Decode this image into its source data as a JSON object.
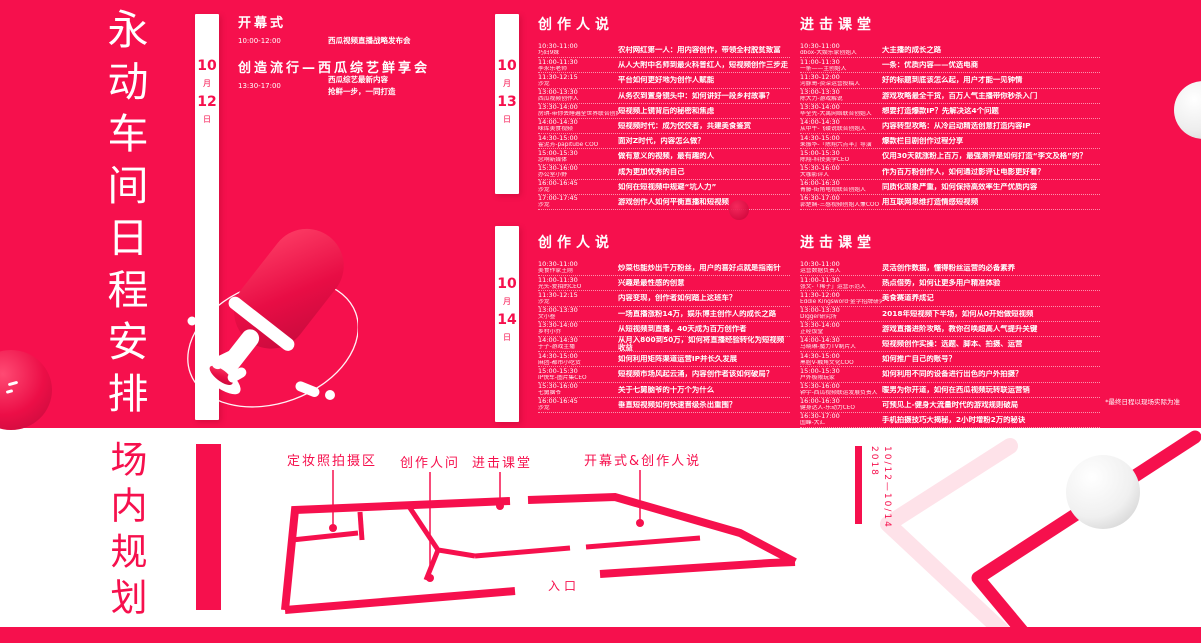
{
  "accent_color": "#F6104D",
  "poster_title": "永动车间日程安排",
  "venue_title": "场内规划",
  "footnote": "*最终日程以现场实际为准",
  "days": {
    "d12": {
      "month": "10",
      "month_label": "月",
      "day": "12",
      "day_label": "日"
    },
    "d13": {
      "month": "10",
      "month_label": "月",
      "day": "13",
      "day_label": "日"
    },
    "d14": {
      "month": "10",
      "month_label": "月",
      "day": "14",
      "day_label": "日"
    }
  },
  "opening": {
    "s1_title": "开幕式",
    "s1_time": "10:00-12:00",
    "s1_desc": "西瓜视频直播战略发布会",
    "s2_title": "创造流行—西瓜综艺鲜享会",
    "s2_time": "13:30-17:00",
    "s2_desc1": "西瓜综艺最新内容",
    "s2_desc2": "抢鲜一步，一同打造"
  },
  "day13": {
    "creators": {
      "header": "创作人说",
      "rows": [
        {
          "time": "10:30-11:00",
          "who": "巧妇9妹",
          "topic": "农村网红第一人：用内容创作，带领全村脱贫致富"
        },
        {
          "time": "11:00-11:30",
          "who": "李永乐老师",
          "topic": "从人大附中名师到最火科普红人，短视频创作三步走"
        },
        {
          "time": "11:30-12:15",
          "who": "沙龙",
          "topic": "平台如何更好地为创作人赋能"
        },
        {
          "time": "13:00-13:30",
          "who": "西瓜视频创作人",
          "topic": "从务农到置身镜头中：如何讲好一段乡村故事？"
        },
        {
          "time": "13:30-14:00",
          "who": "房琪-带你去睡遍全世界联合创始人",
          "topic": "短视频上镜背后的秘密和焦虑"
        },
        {
          "time": "14:00-14:30",
          "who": "味库美食视频",
          "topic": "短视频时代：成为佼佼者，共建美食鉴赏"
        },
        {
          "time": "14:30-15:00",
          "who": "霍泥芳-papitube COO",
          "topic": "面对Z时代，内容怎么做？"
        },
        {
          "time": "15:00-15:30",
          "who": "念响新媒体",
          "topic": "做有意义的视频，最有趣的人"
        },
        {
          "time": "15:30-16:00",
          "who": "办公室小野",
          "topic": "成为更加优秀的自己"
        },
        {
          "time": "16:00-16:45",
          "who": "沙龙",
          "topic": "如何在短视频中规避“坑人力”"
        },
        {
          "time": "17:00-17:45",
          "who": "沙龙",
          "topic": "游戏创作人如何平衡直播和短视频"
        }
      ]
    },
    "classroom": {
      "header": "进击课堂",
      "rows": [
        {
          "time": "10:30-11:00",
          "who": "dbox-大娱乐家创始人",
          "topic": "大主播的成长之路"
        },
        {
          "time": "11:00-11:30",
          "who": "一条——主创始人",
          "topic": "一条：优质内容——优选电商"
        },
        {
          "time": "11:30-12:00",
          "who": "河豚哥-资深运营投稿人",
          "topic": "好的标题到底该怎么起，用户才能一见钟情"
        },
        {
          "time": "13:00-13:30",
          "who": "陈大力-游戏解说",
          "topic": "游戏攻略最全干货，百万人气主播带你秒杀入门"
        },
        {
          "time": "13:30-14:00",
          "who": "毕全先-大禹网络联合创始人",
          "topic": "想要打造爆款IP？先解决这4个问题"
        },
        {
          "time": "14:00-14:30",
          "who": "从中午-飞碟说联合创始人",
          "topic": "内容转型攻略：从冷启动精选创意打造内容IP"
        },
        {
          "time": "14:30-15:00",
          "who": "朱振华-『陈翔六点半』导演",
          "topic": "爆款栏目剧创作过程分享"
        },
        {
          "time": "15:00-15:30",
          "who": "陈翔-科技美学CEO",
          "topic": "仅用30天就涨粉上百万，最强测评是如何打造“李文及格”的？"
        },
        {
          "time": "15:30-16:00",
          "who": "大咖影评人",
          "topic": "作为百万粉创作人，如何通过影评让电影更好看？"
        },
        {
          "time": "16:00-16:30",
          "who": "青藤-街角电视联合创始人",
          "topic": "同质化现象严重，如何保持高效率生产优质内容"
        },
        {
          "time": "16:30-17:00",
          "who": "郭楚娴-三感视频创始人兼COO",
          "topic": "用互联网思维打造情感短视频"
        }
      ]
    }
  },
  "day14": {
    "creators": {
      "header": "创作人说",
      "rows": [
        {
          "time": "10:30-11:00",
          "who": "美食作家王刚",
          "topic": "炒菜也能炒出千万粉丝，用户的喜好点就是指南针"
        },
        {
          "time": "11:00-11:30",
          "who": "光头-爱拍的CEO",
          "topic": "兴趣是最性感的创意"
        },
        {
          "time": "11:30-12:15",
          "who": "沙龙",
          "topic": "内容变现，创作者如何踏上这班车？"
        },
        {
          "time": "13:00-13:30",
          "who": "文小叁",
          "topic": "一场直播涨粉14万，娱乐博主创作人的成长之路"
        },
        {
          "time": "13:30-14:00",
          "who": "乡村小乔",
          "topic": "从短视频到直播，40天成为百万创作者"
        },
        {
          "time": "14:00-14:30",
          "who": "于子-游戏主播",
          "topic": "从月入800到50万，如何将直播经验转化为短视频收益"
        },
        {
          "time": "14:30-15:00",
          "who": "麻团-都市小吃货",
          "topic": "如何利用矩阵渠道运营IP并长久发展"
        },
        {
          "time": "15:00-15:30",
          "who": "IP快车-图片集CEO",
          "topic": "短视频市场风起云涌，内容创作者该如何破局？"
        },
        {
          "time": "15:30-16:00",
          "who": "七舅脑爷",
          "topic": "关于七舅脑爷的十万个为什么"
        },
        {
          "time": "16:00-16:45",
          "who": "沙龙",
          "topic": "垂直短视频如何快速晋级杀出重围？"
        }
      ]
    },
    "classroom": {
      "header": "进击课堂",
      "rows": [
        {
          "time": "10:30-11:00",
          "who": "运营数据负责人",
          "topic": "灵活创作数据，懂得粉丝运营的必备素养"
        },
        {
          "time": "11:00-11:30",
          "who": "张文-「稀子」运营示范人",
          "topic": "热点借势，如何让更多用户精准体验"
        },
        {
          "time": "11:30-12:00",
          "who": "Eddie Kingsword·金字招牌研究室",
          "topic": "美食赛道养成记"
        },
        {
          "time": "13:00-13:30",
          "who": "Digger研究所",
          "topic": "2018年短视频下半场，如何从0开始做短视频"
        },
        {
          "time": "13:30-14:00",
          "who": "正经饭堂",
          "topic": "游戏直播进阶攻略，教你召唤超高人气提升关键"
        },
        {
          "time": "14:00-14:30",
          "who": "马晓琳-魔力TV制片人",
          "topic": "短视频创作实操：选题、脚本、拍摄、运营"
        },
        {
          "time": "14:30-15:00",
          "who": "黑脸V-触角文化COO",
          "topic": "如何推广自己的账号？"
        },
        {
          "time": "15:00-15:30",
          "who": "户外极限玩家",
          "topic": "如何利用不同的设备进行出色的户外拍摄？"
        },
        {
          "time": "15:30-16:00",
          "who": "钟宇-西瓜视频联运发展负责人",
          "topic": "暖男为你开道，如何在西瓜视频玩转联运营销"
        },
        {
          "time": "16:00-16:30",
          "who": "健身达人-乐动力CEO",
          "topic": "可预见上-健身大流量时代的游戏规则破局"
        },
        {
          "time": "16:30-17:00",
          "who": "国峰-大汇",
          "topic": "手机拍摄技巧大揭秘，2小时增粉2万的秘诀"
        }
      ]
    }
  },
  "venue": {
    "label_photo": "定妆照拍摄区",
    "label_ask": "创作人问",
    "label_class": "进击课堂",
    "label_opening": "开幕式&创作人说",
    "entrance": "入口",
    "year": "2018",
    "dates": "10/12—10/14"
  }
}
